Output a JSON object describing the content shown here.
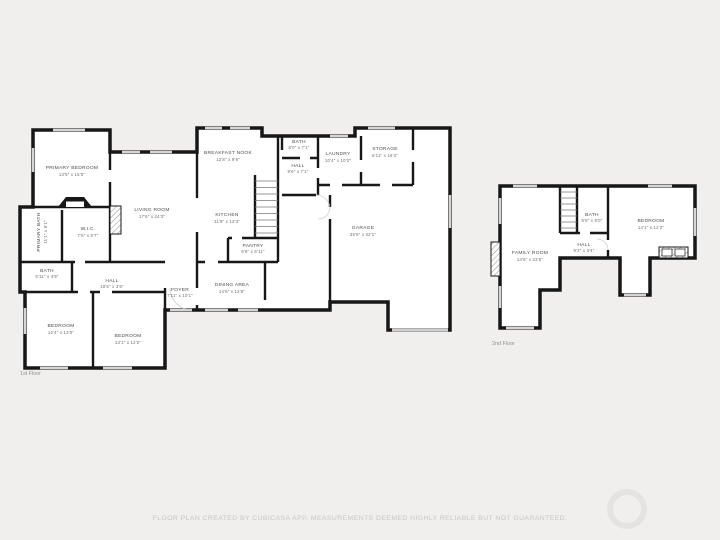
{
  "page": {
    "background": "#f0efee",
    "wall_color": "#171717",
    "window_color": "#d6d6d6",
    "label_color": "#4c4c4c"
  },
  "footer": {
    "text": "FLOOR PLAN CREATED BY CUBICASA APP. MEASUREMENTS DEEMED HIGHLY RELIABLE BUT NOT GUARANTEED."
  },
  "floor1": {
    "label": "1st Floor",
    "rooms": [
      {
        "name": "PRIMARY BEDROOM",
        "dims": "13'5\" x 15'5\""
      },
      {
        "name": "PRIMARY BATH",
        "dims": "11'1\" x 6'1\""
      },
      {
        "name": "W.I.C.",
        "dims": "7'5\" x 5'7\""
      },
      {
        "name": "LIVING ROOM",
        "dims": "17'6\" x 24'3\""
      },
      {
        "name": "BREAKFAST NOOK",
        "dims": "12'8\" x 9'9\""
      },
      {
        "name": "KITCHEN",
        "dims": "11'8\" x 13'3\""
      },
      {
        "name": "BATH",
        "dims": "8'0\" x 7'1\""
      },
      {
        "name": "HALL",
        "dims": "9'6\" x 7'1\""
      },
      {
        "name": "LAUNDRY",
        "dims": "10'4\" x 10'2\""
      },
      {
        "name": "STORAGE",
        "dims": "6'11\" x 16'3\""
      },
      {
        "name": "GARAGE",
        "dims": "35'8\" x 32'1\""
      },
      {
        "name": "PANTRY",
        "dims": "6'6\" x 5'11\""
      },
      {
        "name": "DINING AREA",
        "dims": "14'6\" x 12'8\""
      },
      {
        "name": "FOYER",
        "dims": "7'11\" x 10'1\""
      },
      {
        "name": "BATH",
        "dims": "5'11\" x 4'9\""
      },
      {
        "name": "HALL",
        "dims": "18'5\" x 3'6\""
      },
      {
        "name": "BEDROOM",
        "dims": "12'4\" x 13'0\""
      },
      {
        "name": "BEDROOM",
        "dims": "13'1\" x 12'2\""
      }
    ]
  },
  "floor2": {
    "label": "2nd Floor",
    "rooms": [
      {
        "name": "FAMILY ROOM",
        "dims": "14'6\" x 23'5\""
      },
      {
        "name": "HALL",
        "dims": "9'2\" x 3'4\""
      },
      {
        "name": "BATH",
        "dims": "5'8\" x 9'0\""
      },
      {
        "name": "BEDROOM",
        "dims": "14'1\" x 12'2\""
      }
    ]
  }
}
